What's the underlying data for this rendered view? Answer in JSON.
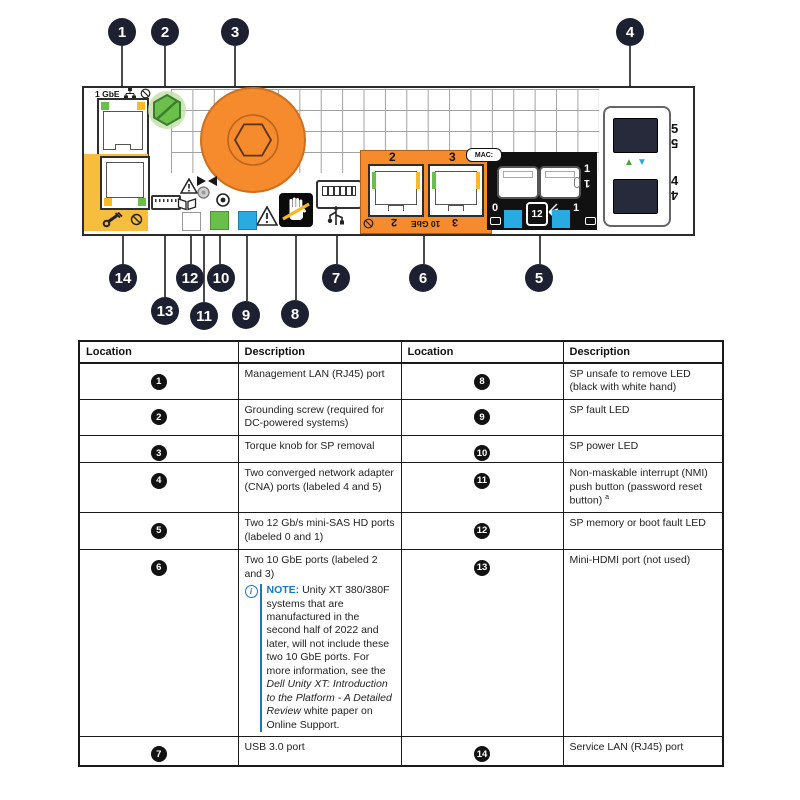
{
  "diagram": {
    "callouts": {
      "top": [
        "1",
        "2",
        "3",
        "4"
      ],
      "bottom": [
        "14",
        "13",
        "12",
        "11",
        "10",
        "9",
        "8",
        "7",
        "6",
        "5"
      ]
    },
    "labels": {
      "mgmt_speed": "1 GbE",
      "port2": "2",
      "port3": "3",
      "ten_gbe": "10 GbE",
      "mac": "MAC:",
      "sas0": "0",
      "sas1": "1",
      "sas_speed": "12",
      "cna4": "4",
      "cna5": "5"
    },
    "icons": {
      "cna_up_triangle": "▲",
      "cna_down_triangle": "▼",
      "info": "i"
    },
    "colors": {
      "orange": "#f68b2e",
      "panel_yellow": "#f7bd3e",
      "led_green": "#6abf4b",
      "led_yellow": "#fdb924",
      "led_blue": "#29abe2",
      "screw_green": "#6cbf4a",
      "callout_black": "#1d2030",
      "note_blue": "#1878be"
    }
  },
  "table": {
    "headers": [
      "Location",
      "Description",
      "Location",
      "Description"
    ],
    "rows": [
      {
        "loc1": "1",
        "desc1": "Management LAN (RJ45) port",
        "loc2": "8",
        "desc2": "SP unsafe to remove LED (black with white hand)"
      },
      {
        "loc1": "2",
        "desc1": "Grounding screw (required for DC-powered systems)",
        "loc2": "9",
        "desc2": "SP fault LED"
      },
      {
        "loc1": "3",
        "desc1": "Torque knob for SP removal",
        "loc2": "10",
        "desc2": "SP power LED"
      },
      {
        "loc1": "4",
        "desc1": "Two converged network adapter (CNA) ports (labeled 4 and 5)",
        "loc2": "11",
        "desc2": "Non-maskable interrupt (NMI) push button (password reset button)",
        "desc2_sup": "a"
      },
      {
        "loc1": "5",
        "desc1": "Two 12 Gb/s mini-SAS HD ports (labeled 0 and 1)",
        "loc2": "12",
        "desc2": "SP memory or boot fault LED"
      },
      {
        "loc1": "6",
        "desc1": "Two 10 GbE ports (labeled 2 and 3)",
        "loc2": "13",
        "desc2": "Mini-HDMI port (not used)"
      },
      {
        "loc1": "7",
        "desc1": "USB 3.0 port",
        "loc2": "14",
        "desc2": "Service LAN (RJ45) port"
      }
    ],
    "note": {
      "label": "NOTE:",
      "text1": " Unity XT 380/380F systems that are manufactured in the second half of 2022 and later, will not include these two 10 GbE ports. For more information, see the ",
      "italic": "Dell Unity XT: Introduction to the Platform - A Detailed Review",
      "text2": " white paper on Online Support."
    }
  }
}
